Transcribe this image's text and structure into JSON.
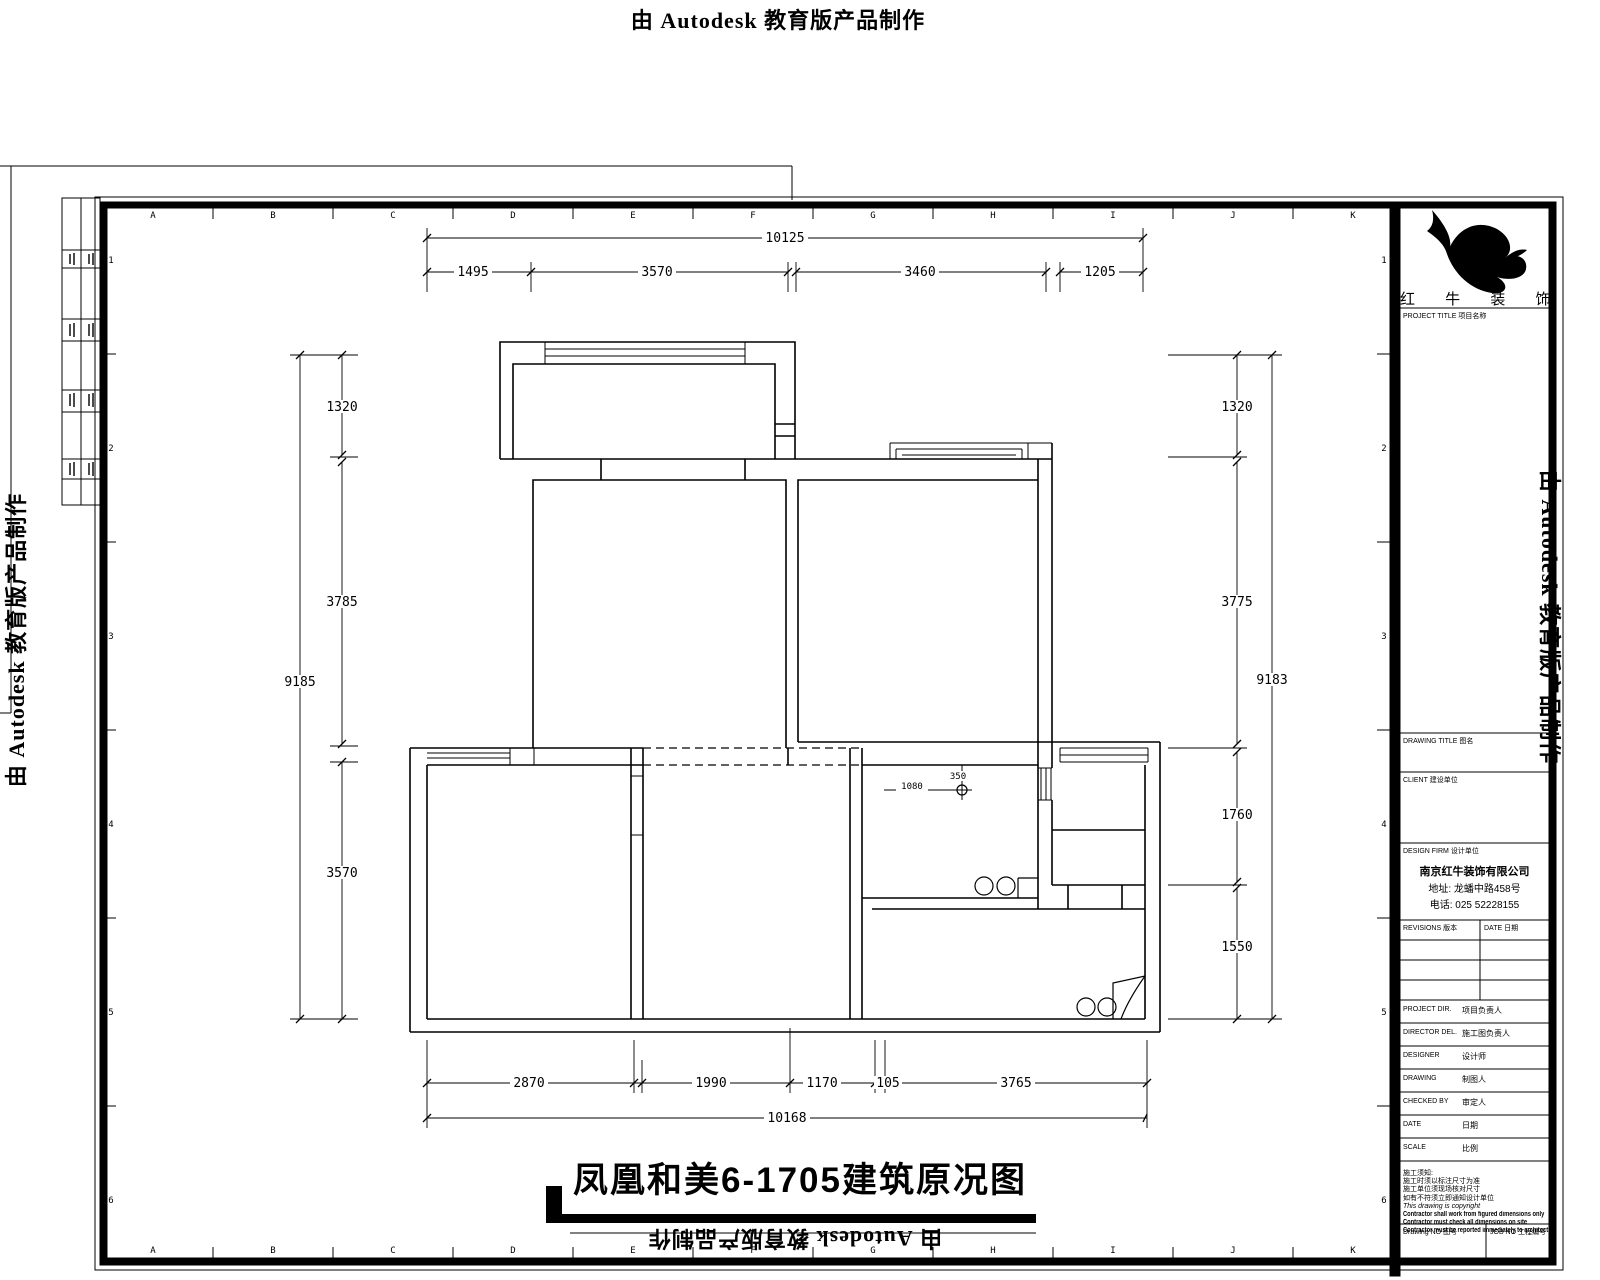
{
  "watermark": {
    "text": "由 Autodesk 教育版产品制作"
  },
  "sheet": {
    "letters": [
      "A",
      "B",
      "C",
      "D",
      "E",
      "F",
      "G",
      "H",
      "I",
      "J",
      "K"
    ],
    "numbers": [
      "1",
      "2",
      "3",
      "4",
      "5",
      "6"
    ]
  },
  "plan": {
    "title": "凤凰和美6-1705建筑原况图",
    "labels": {
      "drain_v": "350",
      "drain_h": "1080"
    },
    "dims": {
      "top_overall": "10125",
      "top_segments": [
        "1495",
        "3570",
        "3460",
        "1205"
      ],
      "left_overall": "9185",
      "left_segments": [
        "1320",
        "3785",
        "3570"
      ],
      "right_overall": "9183",
      "right_segments": [
        "1320",
        "3775",
        "1760",
        "1550"
      ],
      "bottom_overall": "10168",
      "bottom_segments": [
        "2870",
        "1990",
        "1170",
        "105",
        "3765"
      ]
    }
  },
  "title_block": {
    "logo_text": "红 牛 装 饰",
    "project_title_label": "PROJECT TITLE 项目名称",
    "drawing_title_label": "DRAWING TITLE 图名",
    "client_label": "CLIENT 建设单位",
    "design_firm_label": "DESIGN FIRM 设计单位",
    "company": {
      "name": "南京红牛装饰有限公司",
      "address": "地址: 龙蟠中路458号",
      "phone": "电话: 025 52228155"
    },
    "revisions_label": "REVISIONS 版本",
    "date_col_label": "DATE 日期",
    "rows": [
      {
        "en": "PROJECT DIR.",
        "cn": "项目负责人"
      },
      {
        "en": "DIRECTOR DEL.",
        "cn": "施工图负责人"
      },
      {
        "en": "DESIGNER",
        "cn": "设计师"
      },
      {
        "en": "DRAWING",
        "cn": "制图人"
      },
      {
        "en": "CHECKED BY",
        "cn": "审定人"
      },
      {
        "en": "DATE",
        "cn": "日期"
      },
      {
        "en": "SCALE",
        "cn": "比例"
      }
    ],
    "notes": [
      "施工须知:",
      "施工时须以标注尺寸为准",
      "施工单位须现场核对尺寸",
      "如有不符须立即通知设计单位",
      "This drawing is copyright",
      "Contractor shall work from figured dimensions only",
      "Contractor must check all dimensions on site",
      "Contractor must be reported immediately to architects"
    ],
    "drawing_no_label": "Drawing NO 图号",
    "job_no_label": "JOB NO 工程编号"
  }
}
